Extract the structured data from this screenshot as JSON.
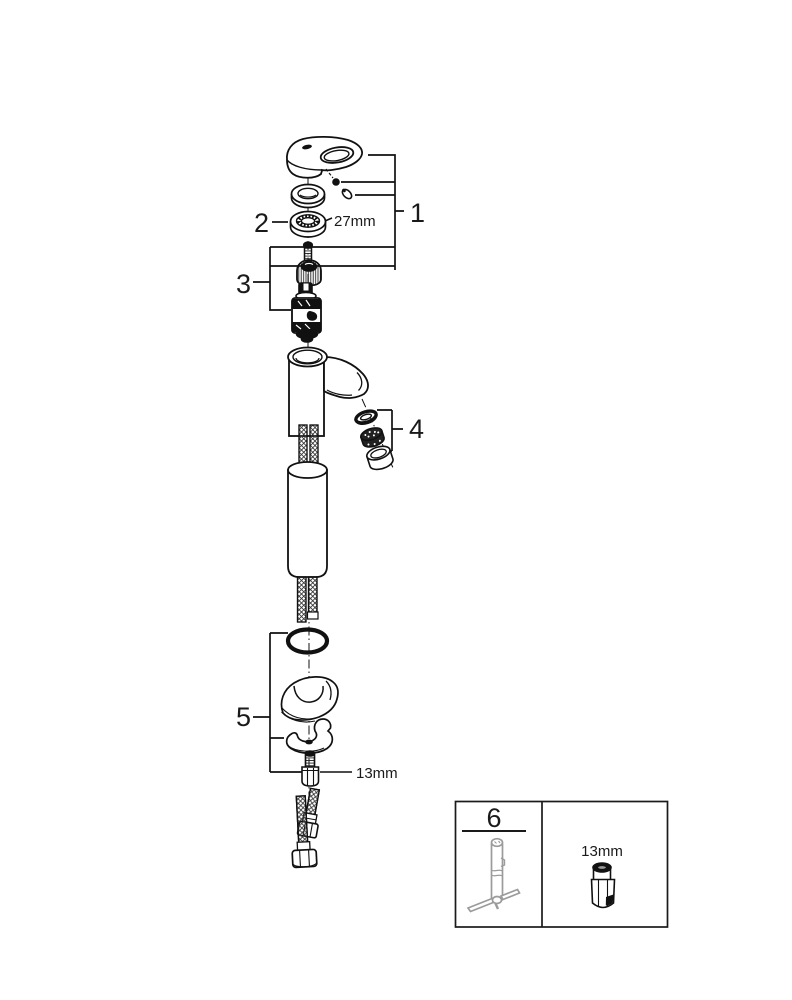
{
  "page": {
    "background": "#ffffff"
  },
  "diagram": {
    "kind": "faucet-exploded-parts-diagram",
    "line_color": "#111111",
    "tool_color": "#9b9b9b",
    "callouts": {
      "c1": "1",
      "c2": "2",
      "c3": "3",
      "c4": "4",
      "c5": "5",
      "c6": "6"
    },
    "measurements": {
      "escutcheon_ring": "27mm",
      "mounting_bolt": "13mm",
      "legend_socket": "13mm"
    }
  }
}
